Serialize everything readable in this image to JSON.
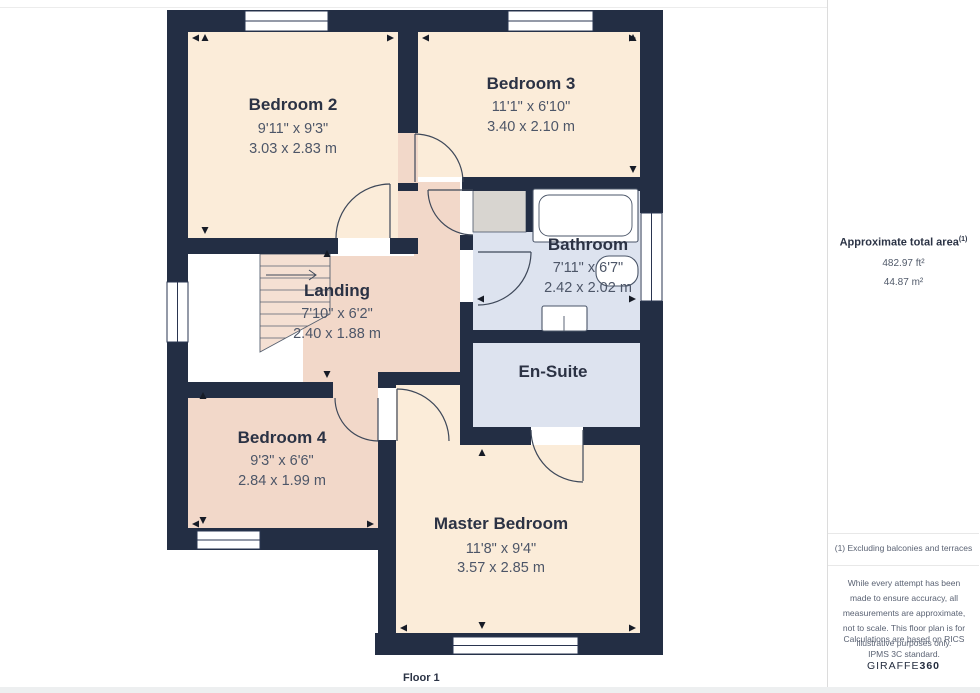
{
  "floor_label": "Floor 1",
  "rooms": {
    "bedroom2": {
      "name": "Bedroom 2",
      "dims_ft": "9'11\" x 9'3\"",
      "dims_m": "3.03 x 2.83 m"
    },
    "bedroom3": {
      "name": "Bedroom 3",
      "dims_ft": "11'1\" x 6'10\"",
      "dims_m": "3.40 x 2.10 m"
    },
    "landing": {
      "name": "Landing",
      "dims_ft": "7'10\" x 6'2\"",
      "dims_m": "2.40 x 1.88 m"
    },
    "bathroom": {
      "name": "Bathroom",
      "dims_ft": "7'11\" x 6'7\"",
      "dims_m": "2.42 x 2.02 m"
    },
    "ensuite": {
      "name": "En-Suite"
    },
    "bedroom4": {
      "name": "Bedroom 4",
      "dims_ft": "9'3\" x 6'6\"",
      "dims_m": "2.84 x 1.99 m"
    },
    "master": {
      "name": "Master Bedroom",
      "dims_ft": "11'8\" x 9'4\"",
      "dims_m": "3.57 x 2.85 m"
    }
  },
  "sidebar": {
    "title": "Approximate total area",
    "footnote_marker": "(1)",
    "area_ft": "482.97 ft²",
    "area_m": "44.87 m²",
    "note1": "(1) Excluding balconies and terraces",
    "disclaimer": "While every attempt has been made to ensure accuracy, all measurements are approximate, not to scale. This floor plan is for illustrative purposes only.",
    "standard": "Calculations are based on RICS IPMS 3C standard.",
    "brand_name": "GIRAFFE",
    "brand_suffix": "360"
  },
  "colors": {
    "wall": "#232e44",
    "cream": "#fbecd9",
    "pink": "#f2d8c9",
    "stairs": "#f5e0d3",
    "blue": "#dde3ef",
    "closet_gray": "#d8d5d0",
    "window_white": "#ffffff"
  }
}
